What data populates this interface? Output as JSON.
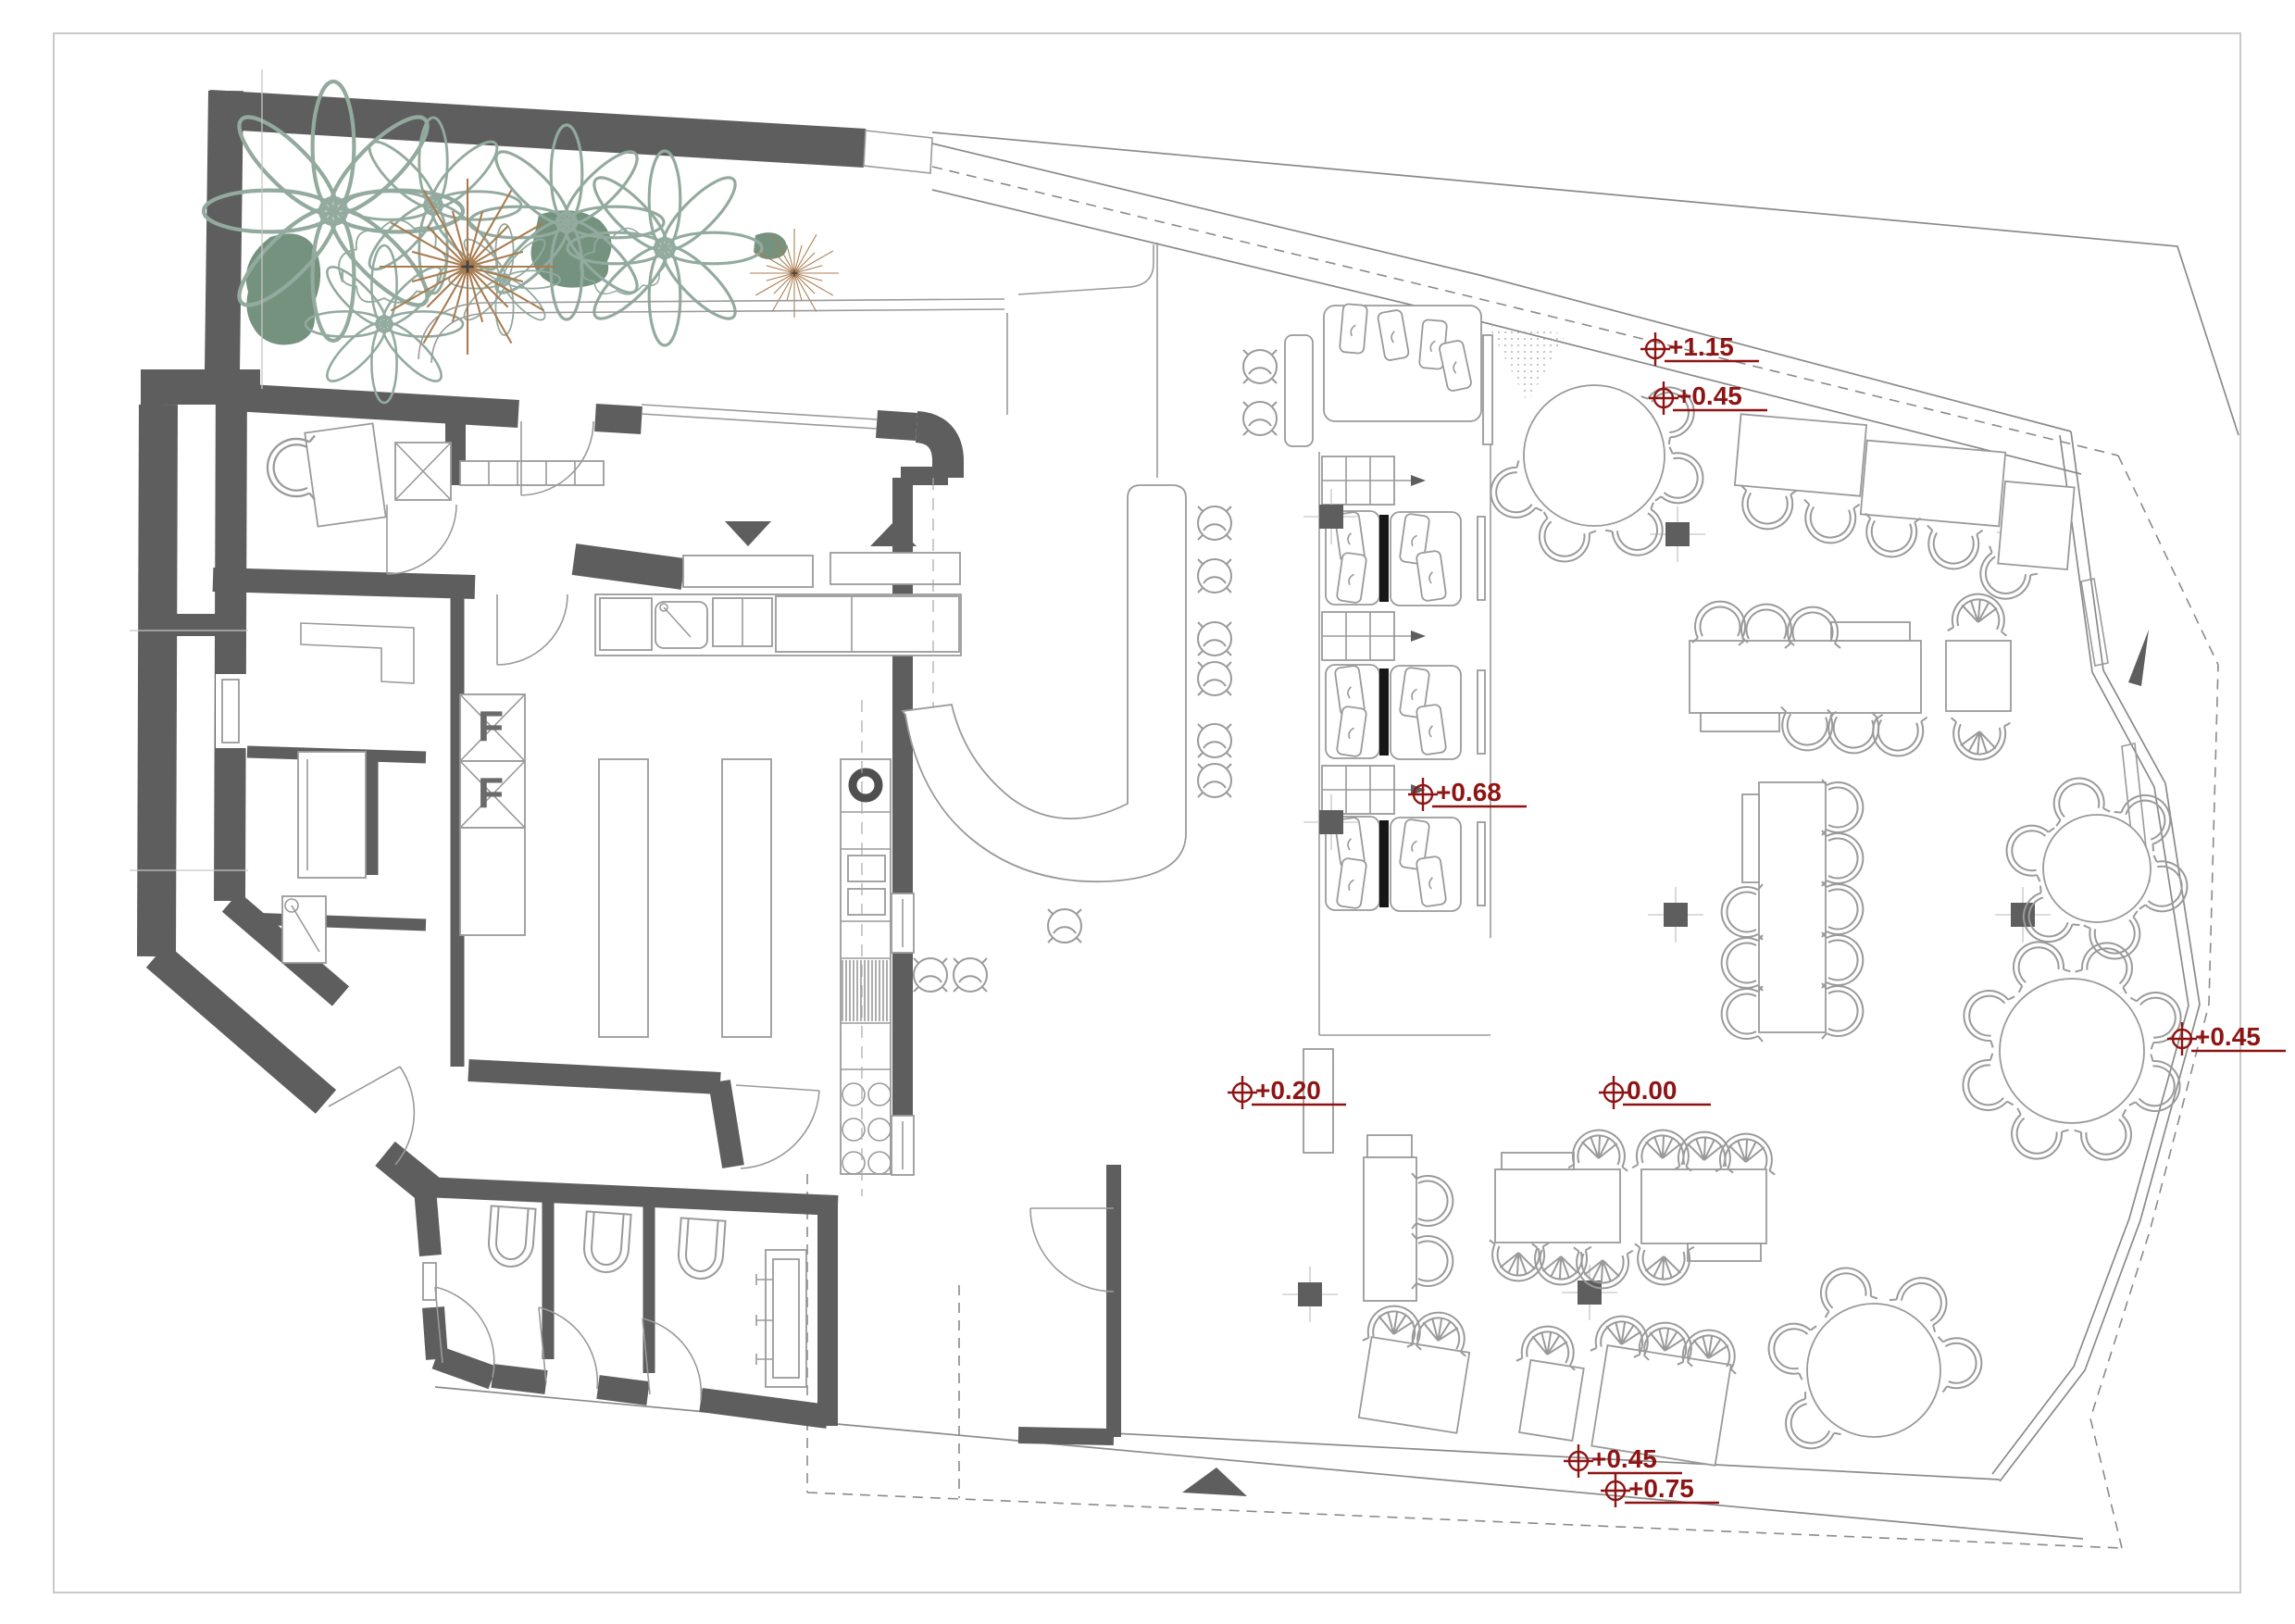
{
  "levels": [
    {
      "id": "street-upper",
      "value": "+1.15"
    },
    {
      "id": "terrace-upper",
      "value": "+0.45"
    },
    {
      "id": "booth-platform",
      "value": "+0.68"
    },
    {
      "id": "kitchen",
      "value": "+0.20"
    },
    {
      "id": "dining-hall",
      "value": "0.00"
    },
    {
      "id": "terrace-right",
      "value": "+0.45"
    },
    {
      "id": "terrace-bottom",
      "value": "+0.45"
    },
    {
      "id": "street-lower",
      "value": "+0.75"
    }
  ],
  "equipment": {
    "fridge_a": "F",
    "fridge_b": "F"
  },
  "colors": {
    "wall": "#5e5e5e",
    "furniture_line": "#9a9a9a",
    "level_marker": "#8e1414",
    "plant_fill": "#75927f",
    "plant_star": "#a97c50",
    "plant_outline": "#93aa9e",
    "booth_divider": "#161616",
    "background": "#ffffff"
  },
  "icons": {
    "level_marker": "circle-cross-datum",
    "entrance_arrow": "solid-triangle",
    "north_pointer": "solid-wedge",
    "serving_hatch_in": "triangle-down",
    "serving_hatch_out": "triangle-up",
    "column": "filled-square-crosshair",
    "stairs": "step-grid-arrow"
  }
}
